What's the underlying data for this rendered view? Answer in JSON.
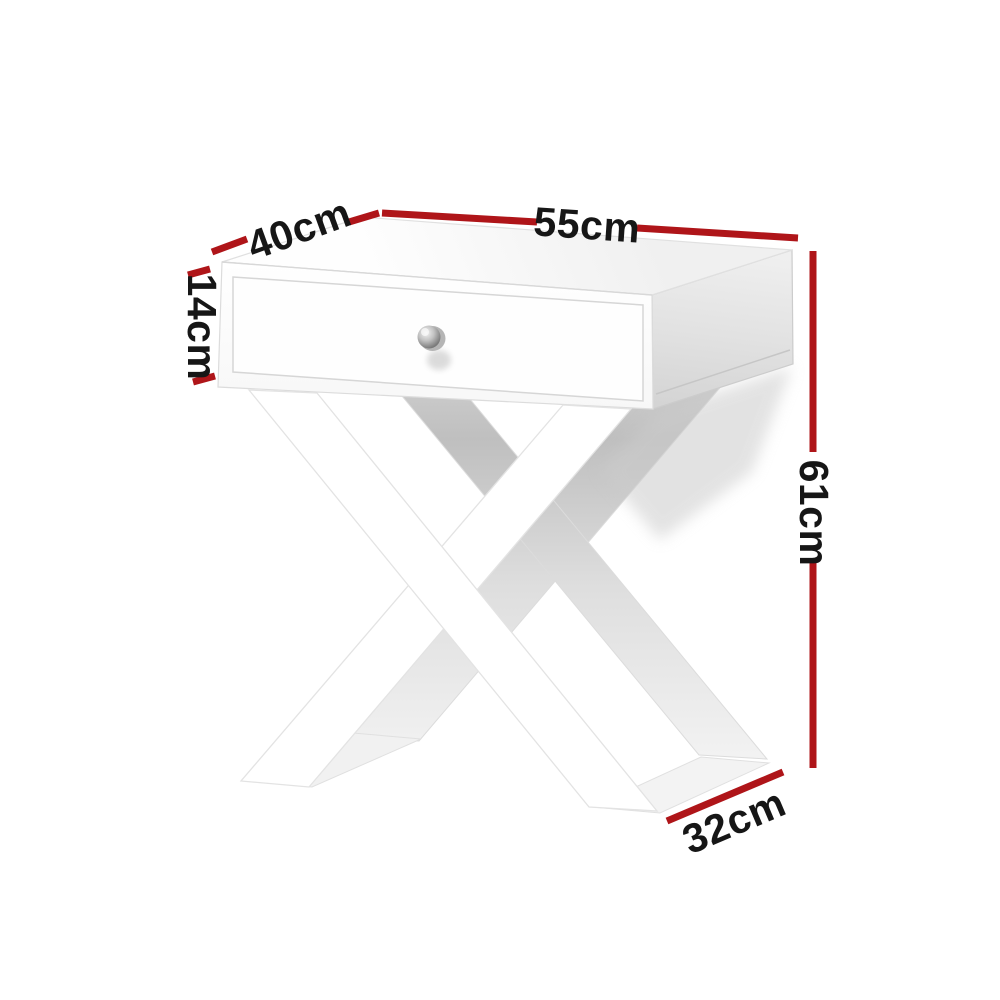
{
  "scene": {
    "description": "White bedside side table with one drawer, silver round knob and X-cross legs, shown on a white background with product dimension annotations"
  },
  "colors": {
    "accent": "#af1519",
    "label_text": "#161616",
    "furniture": "#ffffff",
    "side_shade": "#d7d7d7",
    "background": "#ffffff",
    "knob": "#8a8a8a"
  },
  "measurements": {
    "top_depth": {
      "label": "40cm",
      "value": 40,
      "unit": "cm"
    },
    "top_width": {
      "label": "55cm",
      "value": 55,
      "unit": "cm"
    },
    "drawer_height": {
      "label": "14cm",
      "value": 14,
      "unit": "cm"
    },
    "overall_height": {
      "label": "61cm",
      "value": 61,
      "unit": "cm"
    },
    "base_depth": {
      "label": "32cm",
      "value": 32,
      "unit": "cm"
    }
  }
}
